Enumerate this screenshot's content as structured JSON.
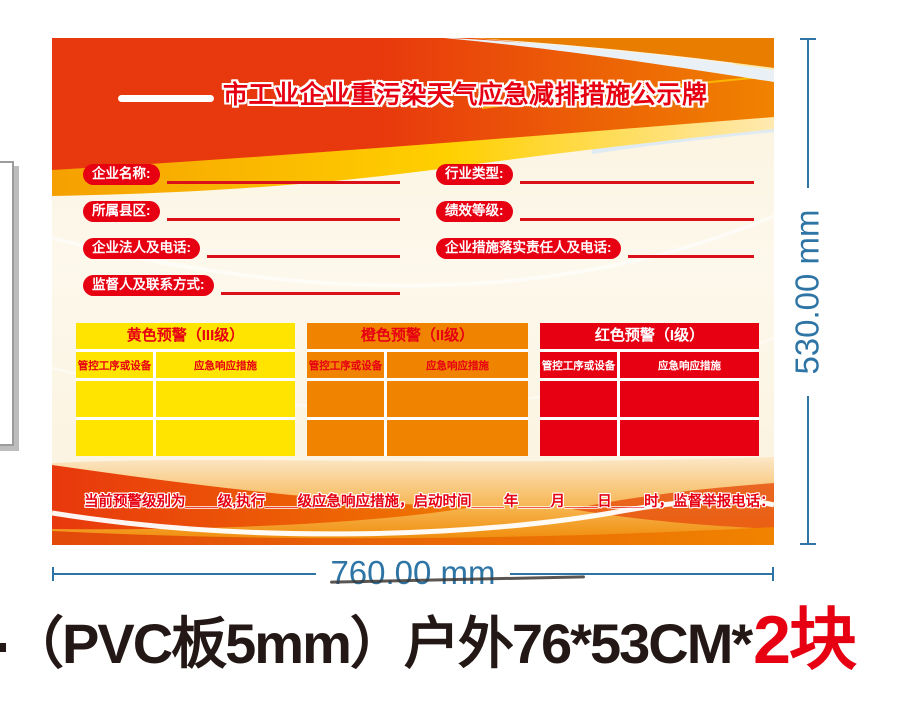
{
  "poster": {
    "title": "市工业企业重污染天气应急减排措施公示牌",
    "fields": {
      "left": [
        {
          "label": "企业名称:"
        },
        {
          "label": "所属县区:"
        },
        {
          "label": "企业法人及电话:"
        },
        {
          "label": "监督人及联系方式:"
        }
      ],
      "right": [
        {
          "label": "行业类型:"
        },
        {
          "label": "绩效等级:"
        },
        {
          "label": "企业措施落实责任人及电话:"
        }
      ]
    },
    "warning_tables": [
      {
        "title": "黄色预警（III级）",
        "col1": "管控工序或设备",
        "col2": "应急响应措施",
        "bg_color": "#ffe400",
        "text_color": "#e60012"
      },
      {
        "title": "橙色预警（II级）",
        "col1": "管控工序或设备",
        "col2": "应急响应措施",
        "bg_color": "#f08300",
        "text_color": "#e60012"
      },
      {
        "title": "红色预警（I级）",
        "col1": "管控工序或设备",
        "col2": "应急响应措施",
        "bg_color": "#e60012",
        "text_color": "#ffffff"
      }
    ],
    "footer_text": "当前预警级别为____级,执行____级应急响应措施，启动时间____年____月____日____时，监督举报电话："
  },
  "dimensions": {
    "width_label": "760.00 mm",
    "height_label": "530.00 mm",
    "line_color": "#2e75a6"
  },
  "caption": {
    "spec_text": "（PVC板5mm）户外76*53CM*",
    "quantity_text": "2块",
    "quantity_color": "#e60012"
  },
  "colors": {
    "brand_red": "#e8380d",
    "main_orange": "#f08300",
    "gold": "#f6a400",
    "cream_background": "#fbf2dd",
    "signal_red": "#e60012"
  }
}
